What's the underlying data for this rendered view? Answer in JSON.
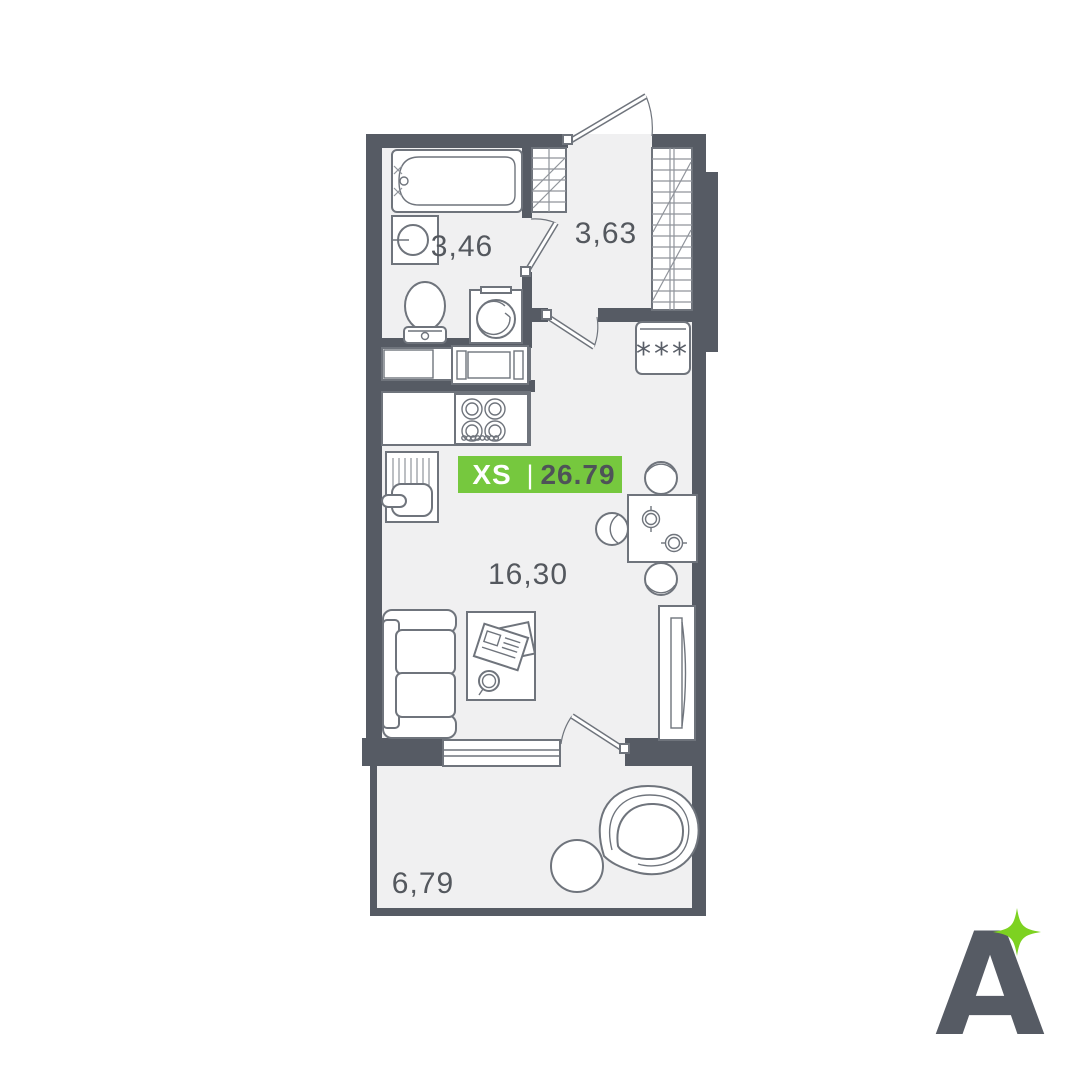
{
  "badge": {
    "size_label": "XS",
    "divider": "|",
    "area_value": "26.79"
  },
  "rooms": {
    "bathroom_area": "3,46",
    "hallway_area": "3,63",
    "living_area": "16,30",
    "balcony_area": "6,79"
  },
  "fridge": {
    "stars": "***"
  },
  "logo": {
    "letter": "A"
  },
  "colors": {
    "wall": "#565B64",
    "floor": "#F0F0F1",
    "fixture_outline": "#6F747C",
    "badge_green": "#76C83E",
    "logo_green": "#7DD221",
    "label_text": "#54585E",
    "badge_area_text": "#4E5358"
  }
}
